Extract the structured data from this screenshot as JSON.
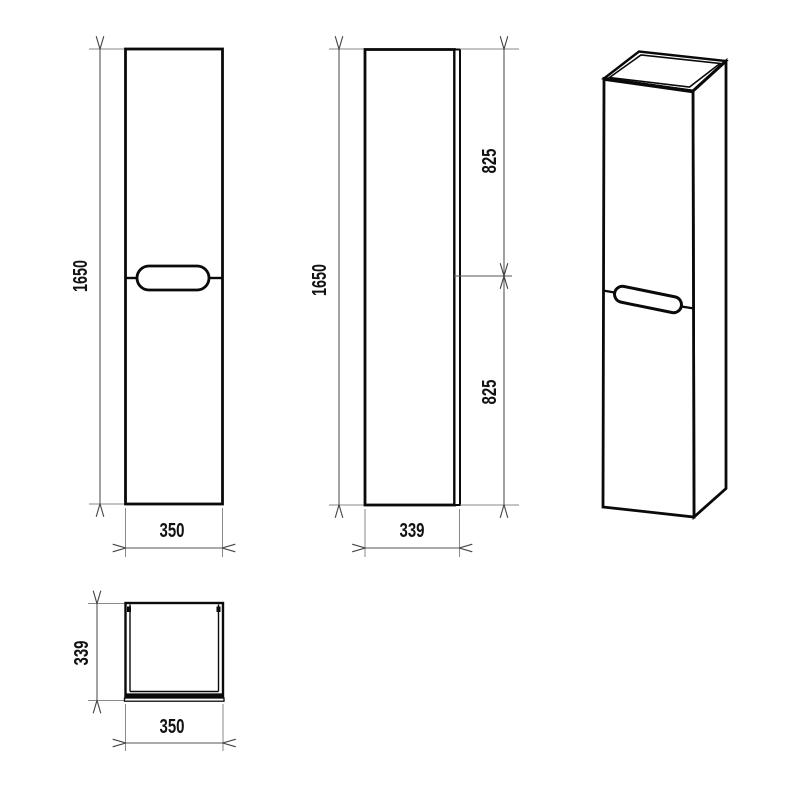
{
  "diagram": {
    "type": "technical-drawing",
    "subject": "tall wall-hung cabinet column with two doors and oval handle",
    "background_color": "#ffffff",
    "object_line_color": "#0a0a0a",
    "dimension_line_color": "#555555",
    "views": {
      "front": {
        "name": "front view",
        "height_label": "1650",
        "width_label": "350"
      },
      "side": {
        "name": "side view",
        "height_label": "1650",
        "upper_section_label": "825",
        "lower_section_label": "825",
        "depth_label": "339"
      },
      "perspective": {
        "name": "perspective view"
      },
      "top": {
        "name": "top view",
        "depth_label": "339",
        "width_label": "350"
      }
    }
  }
}
